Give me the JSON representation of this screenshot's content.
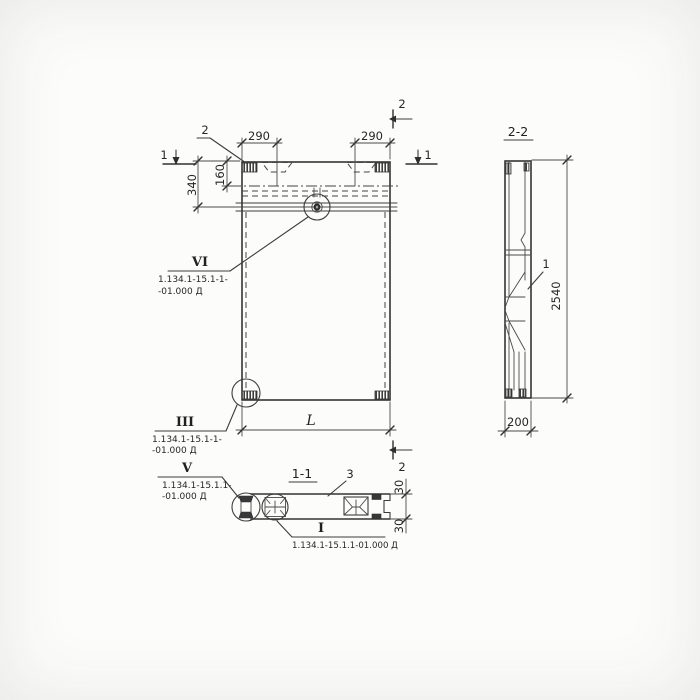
{
  "canvas": {
    "background": "#fcfcfb",
    "ink": "#3c3c3c"
  },
  "front_view": {
    "loop_callout": "2",
    "cut_marks": {
      "left": "1",
      "right": "1",
      "top_right": "2",
      "bottom_right": "2"
    },
    "dimensions": {
      "width_left": "290",
      "width_right": "290",
      "head_height": "340",
      "loop_offset": "160",
      "length": "L"
    }
  },
  "detail_callouts": {
    "vi": {
      "numeral": "VI",
      "ref_line1": "1.134.1-15.1-1-",
      "ref_line2": "-01.000 Д"
    },
    "iii": {
      "numeral": "III",
      "ref_line1": "1.134.1-15.1-1-",
      "ref_line2": "-01.000 Д"
    },
    "v": {
      "numeral": "V",
      "ref_line1": "1.134.1-15.1.1-",
      "ref_line2": "-01.000 Д"
    },
    "i": {
      "numeral": "I",
      "ref": "1.134.1-15.1.1-01.000 Д"
    }
  },
  "section_1_1": {
    "title": "1-1",
    "part_label": "3",
    "dim_top": "30",
    "dim_bottom": "30"
  },
  "section_2_2": {
    "title": "2-2",
    "part_label": "1",
    "dim_height": "2540",
    "dim_width": "200"
  }
}
